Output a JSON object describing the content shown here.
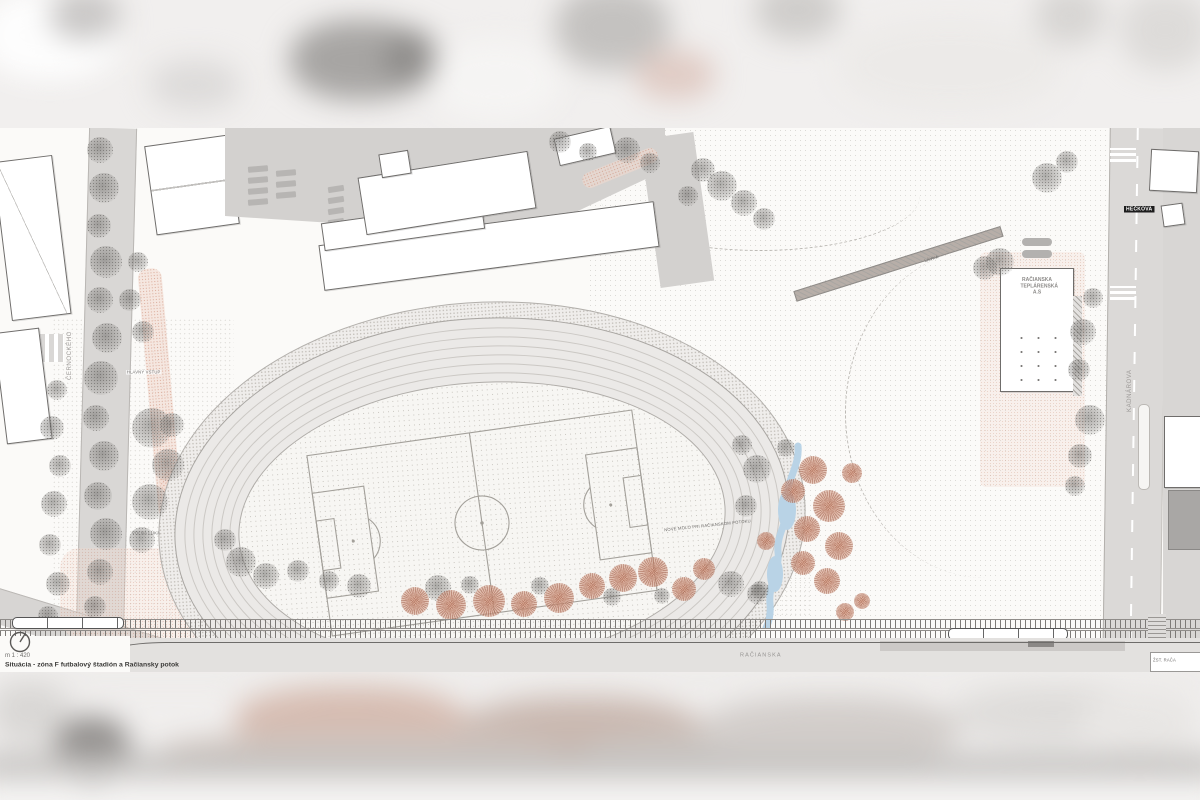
{
  "title_block": {
    "scale": "m 1 : 420",
    "title": "Situácia - zóna F futbalový štadión a Račiansky potok"
  },
  "labels": {
    "street_left_vertical": "ČERNOCKÉHO",
    "street_right_vertical": "KADNÁROVA",
    "street_tag_top_right": "HEČKOVA",
    "street_bottom": "RAČIANSKA",
    "building_heating_plant": "RAČIANSKA TEPLÁRENSKÁ A.S",
    "micro": {
      "entrance": "HLAVNÝ VSTUP",
      "meadow": "VOĽNÁ LÚKA",
      "stream_deck": "NOVÉ MOLO PRI RAČIANSKOM POTOKU",
      "footbridge": "LÁVKA",
      "rail_tag": "ŽST. RAČA"
    }
  },
  "plan": {
    "colors": {
      "paper": "#fbfaf8",
      "plaza_gray": "#d3d1cf",
      "road_gray": "#dbd9d7",
      "track_band": "#ebe9e7",
      "infield": "#f7f6f3",
      "pitch_line": "#a3a09a",
      "tree_gray": "#8a8885",
      "tree_red": "#c08873",
      "path_pink": "#e8c2b2",
      "stream_blue": "#b9d3e6",
      "rail_dark": "#7d7a77"
    },
    "trees": {
      "gray": [
        [
          100,
          150,
          13
        ],
        [
          104,
          188,
          15
        ],
        [
          99,
          226,
          12
        ],
        [
          106,
          262,
          16
        ],
        [
          100,
          300,
          13
        ],
        [
          107,
          338,
          15
        ],
        [
          101,
          378,
          17
        ],
        [
          96,
          418,
          13
        ],
        [
          104,
          456,
          15
        ],
        [
          98,
          496,
          14
        ],
        [
          106,
          534,
          16
        ],
        [
          100,
          572,
          13
        ],
        [
          95,
          607,
          11
        ],
        [
          57,
          390,
          10
        ],
        [
          52,
          428,
          12
        ],
        [
          60,
          466,
          11
        ],
        [
          54,
          504,
          13
        ],
        [
          50,
          545,
          11
        ],
        [
          58,
          584,
          12
        ],
        [
          48,
          616,
          10
        ],
        [
          152,
          428,
          20
        ],
        [
          168,
          465,
          16
        ],
        [
          150,
          502,
          18
        ],
        [
          142,
          540,
          13
        ],
        [
          172,
          425,
          12
        ],
        [
          130,
          300,
          11
        ],
        [
          138,
          262,
          10
        ],
        [
          143,
          332,
          11
        ],
        [
          627,
          150,
          13
        ],
        [
          650,
          163,
          10
        ],
        [
          703,
          170,
          12
        ],
        [
          722,
          186,
          15
        ],
        [
          744,
          203,
          13
        ],
        [
          764,
          219,
          11
        ],
        [
          688,
          196,
          10
        ],
        [
          560,
          142,
          11
        ],
        [
          588,
          152,
          9
        ],
        [
          1047,
          178,
          15
        ],
        [
          1067,
          162,
          11
        ],
        [
          1083,
          332,
          13
        ],
        [
          1079,
          370,
          11
        ],
        [
          1090,
          420,
          15
        ],
        [
          1080,
          456,
          12
        ],
        [
          1093,
          298,
          10
        ],
        [
          985,
          268,
          12
        ],
        [
          1000,
          262,
          14
        ],
        [
          1075,
          486,
          10
        ],
        [
          241,
          562,
          15
        ],
        [
          266,
          576,
          13
        ],
        [
          298,
          571,
          11
        ],
        [
          329,
          581,
          10
        ],
        [
          359,
          586,
          12
        ],
        [
          438,
          588,
          13
        ],
        [
          470,
          585,
          9
        ],
        [
          540,
          586,
          9
        ],
        [
          612,
          597,
          9
        ],
        [
          662,
          596,
          8
        ],
        [
          731,
          584,
          13
        ],
        [
          757,
          594,
          10
        ],
        [
          225,
          540,
          11
        ],
        [
          757,
          469,
          14
        ],
        [
          746,
          506,
          11
        ],
        [
          760,
          590,
          9
        ],
        [
          742,
          445,
          10
        ],
        [
          786,
          448,
          9
        ]
      ],
      "red": [
        [
          415,
          601,
          14
        ],
        [
          451,
          605,
          15
        ],
        [
          489,
          601,
          16
        ],
        [
          524,
          604,
          13
        ],
        [
          559,
          598,
          15
        ],
        [
          592,
          586,
          13
        ],
        [
          623,
          578,
          14
        ],
        [
          653,
          572,
          15
        ],
        [
          684,
          589,
          12
        ],
        [
          704,
          569,
          11
        ],
        [
          813,
          470,
          14
        ],
        [
          793,
          491,
          12
        ],
        [
          829,
          506,
          16
        ],
        [
          807,
          529,
          13
        ],
        [
          839,
          546,
          14
        ],
        [
          803,
          563,
          12
        ],
        [
          827,
          581,
          13
        ],
        [
          852,
          473,
          10
        ],
        [
          862,
          601,
          8
        ],
        [
          845,
          612,
          9
        ],
        [
          766,
          541,
          9
        ]
      ]
    }
  }
}
